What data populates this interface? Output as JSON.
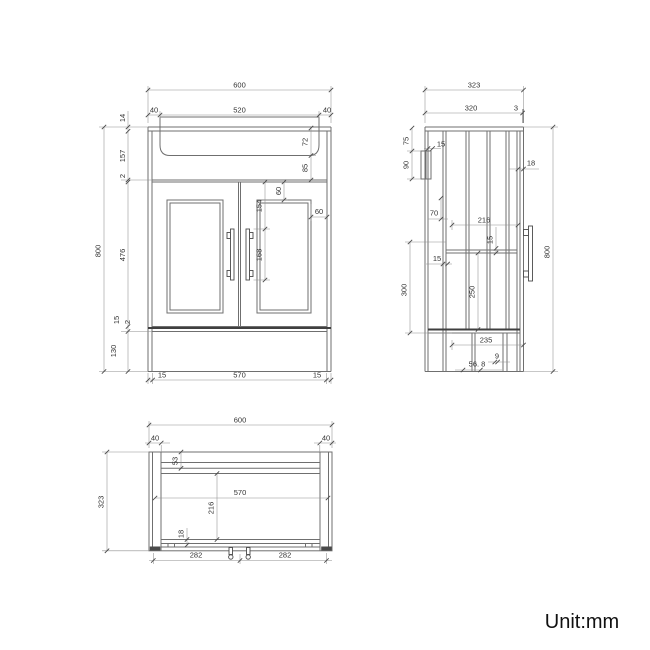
{
  "meta": {
    "drawing_type": "vanity-unit-technical-drawing",
    "background": "#ffffff",
    "line_color": "#6f6f6f",
    "dark_line_color": "#3f3f3f",
    "dimension_line_color": "#8f8f8f",
    "text_color": "#333333",
    "unit_text_color": "#111111"
  },
  "front_view": {
    "dims": {
      "total_width": "600",
      "left_inset": "40",
      "basin_width": "520",
      "right_inset": "40",
      "top_rail": "14",
      "upper_section": "157",
      "gap_top": "2",
      "door_height": "476",
      "bottom_rail": "15",
      "gap_bottom": "2",
      "plinth_height": "130",
      "total_height": "800",
      "basin_depth": "72",
      "apron_height": "85",
      "panel_top_margin": "60",
      "handle_offset": "154",
      "handle_length": "168",
      "panel_side_margin": "60",
      "base_left": "15",
      "base_width": "570",
      "base_right": "15"
    }
  },
  "side_view": {
    "dims": {
      "total_depth": "323",
      "top_depth": "320",
      "back_gap": "3",
      "bracket_offset": "75",
      "bracket_height": "90",
      "bracket_width": "15",
      "front_panel": "18",
      "upper_gap": "70",
      "inner_depth": "216",
      "shelf_inset": "15",
      "front_inset": "15",
      "lower_height": "300",
      "inner_height": "250",
      "total_height": "800",
      "base_depth": "235",
      "foot_width": "9",
      "foot_offset": "56. 8"
    }
  },
  "plan_view": {
    "dims": {
      "total_width": "600",
      "left_inset": "40",
      "right_inset": "40",
      "total_depth": "323",
      "top_band": "53",
      "inner_width": "570",
      "inner_depth": "216",
      "back_band": "18",
      "left_span": "282",
      "right_span": "282"
    }
  },
  "footer": {
    "unit_label": "Unit:mm"
  }
}
